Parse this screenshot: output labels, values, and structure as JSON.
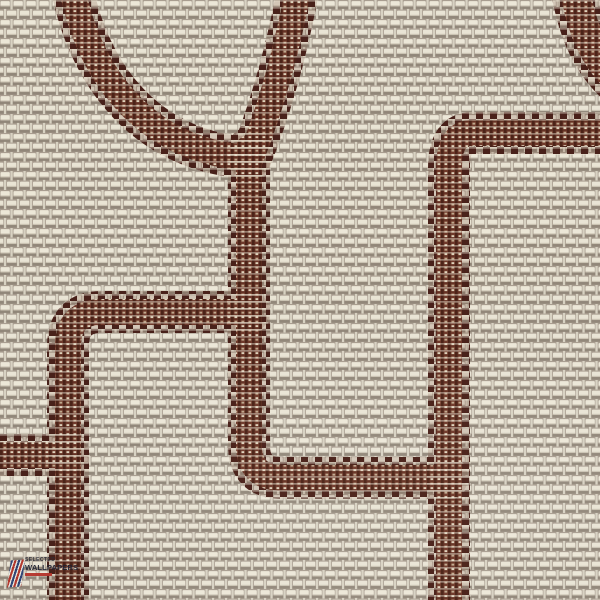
{
  "meta": {
    "description": "Close-up swatch of woven paperweave wallpaper with a chocolate-brown stitched meander and circle motif"
  },
  "palette": {
    "ground_taupe": "#a89d90",
    "ground_shadow": "#91877a",
    "thread_cream": "#ece7d8",
    "thread_grey": "#d8d2c3",
    "band_dark": "#48211a",
    "band_mid": "#6e392b",
    "band_fleck": "#dfd3bc",
    "weft_cream": "#ebe5d4"
  },
  "motif": {
    "band_width": 42,
    "mid_width": 26,
    "weft_width": 44,
    "paths": [
      {
        "name": "circle-arc-top-left",
        "d": "M 72 -12 C 90 80 150 152 250 158",
        "w": 42
      },
      {
        "name": "diagonal-band-top",
        "d": "M 298 -10 C 285 60 268 115 250 160",
        "w": 42
      },
      {
        "name": "main-vertical-to-right",
        "d": "M 249 148 L 249 445 Q 249 478 282 478 L 447 478",
        "w": 42
      },
      {
        "name": "right-band-down",
        "d": "M 606 133 L 472 133 Q 449 133 449 168 L 449 606",
        "w": 42
      },
      {
        "name": "corner-arc-top-right",
        "d": "M 574 -16 C 581 30 596 62 622 84",
        "w": 48
      },
      {
        "name": "left-band-down",
        "d": "M 249 312 L 102 312 Q 68 312 68 346 L 68 606",
        "w": 42
      },
      {
        "name": "left-edge-stub",
        "d": "M -6 455 L 68 455",
        "w": 42
      }
    ]
  },
  "logo": {
    "icon": "striped-flag-icon",
    "line1": "SELECTED",
    "line2": "WALLPAPERS",
    "accent_color": "#b5332a"
  }
}
